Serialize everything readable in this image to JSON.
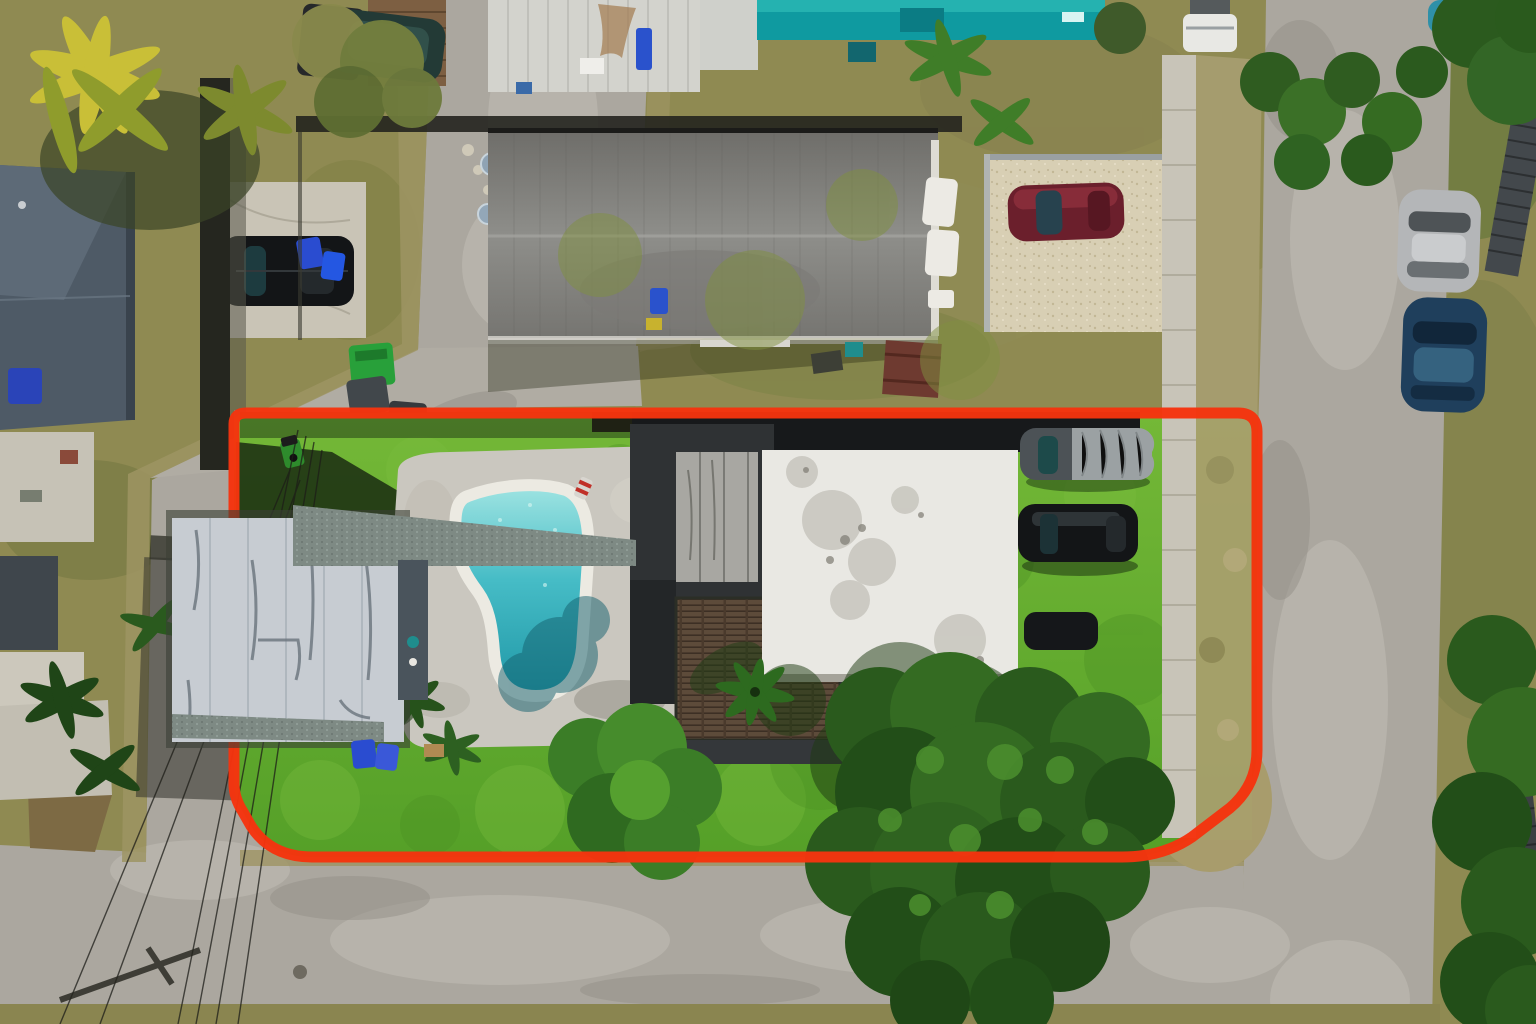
{
  "meta": {
    "kind": "aerial-photograph",
    "subject": "residential-lot-with-pool-and-property-boundary-overlay",
    "width_px": 1536,
    "height_px": 1024
  },
  "boundary": {
    "name": "property-boundary-outline",
    "color": "#f5340e",
    "stroke_width": 11
  },
  "colors": {
    "scrub": "#8f8a52",
    "scrub_dark": "#75743f",
    "dirt": "#9d9463",
    "asphalt": "#aba79f",
    "asphalt_worn": "#c1bdb4",
    "lawn": "#55a028",
    "lawn_light": "#74b837",
    "pool_water_light": "#9fe4e2",
    "pool_water": "#46bcc6",
    "pool_water_deep": "#1f97a6",
    "pool_coping": "#eceae2",
    "pool_deck": "#cac7bf",
    "roof_main": "#e9e8e3",
    "roof_left": "#c7ccd2",
    "roof_north_light": "#8e8e8a",
    "roof_north_dark": "#6f6e6a",
    "roof_charcoal": "#2f3234",
    "roof_west_blue": "#4e5a66",
    "shingle": "#7e8a84",
    "deck_wood": "#5d4b3a",
    "teal_structure": "#0f9aa0",
    "sidewalk": "#c8c4b8",
    "gravel": "#d8cfb4",
    "tree_dark": "#2a5a1d",
    "tree_mid": "#346b22",
    "tree_light": "#4c8f2e",
    "palm_yellow": "#c9bf37",
    "shadow_green": "#1a2b12",
    "car_black": "#131517",
    "car_maroon": "#6b1f2c",
    "car_silver": "#b4b6b8",
    "car_blue": "#1f3f5c",
    "car_cover_gray": "#9ba1a3",
    "curb_yellow": "#e0b33c",
    "bin_blue": "#2a4cd0",
    "bin_green": "#28a03a"
  },
  "features": {
    "inside_lot": [
      "lawn",
      "swimming-pool",
      "pool-deck",
      "pool-ladder",
      "pool-float",
      "main-house-white-flat-roof",
      "guest-house-white-metal-roof",
      "carport-shingle-band",
      "charcoal-roof-section",
      "wood-deck",
      "riding-mower",
      "covered-car",
      "black-suv-on-lawn",
      "partially-hidden-car",
      "palm-trees",
      "shade-trees",
      "sidewalk-strip",
      "blue-trash-bins"
    ],
    "surroundings": [
      "north-neighbor-gray-gable-roof",
      "white-metal-shed",
      "teal-structures",
      "wood-deck-north",
      "gravel-parking-pad",
      "maroon-car",
      "black-suv-on-concrete-pad",
      "west-neighbor-blue-gray-roof",
      "left-street",
      "right-street",
      "bottom-street",
      "street-intersections",
      "silver-car",
      "dark-blue-car",
      "white-pickup-truck",
      "teal-car",
      "dark-teal-suv",
      "trash-bins",
      "green-bin",
      "picnic-table",
      "satellite-dishes",
      "paddle-boards",
      "stepping-stones",
      "corrugated-panels",
      "yellow-striped-curbs",
      "manhole-covers",
      "power-lines",
      "utility-pole-shadow",
      "dirt-patch",
      "street-tree-canopies",
      "top-left-palm-trees"
    ]
  }
}
